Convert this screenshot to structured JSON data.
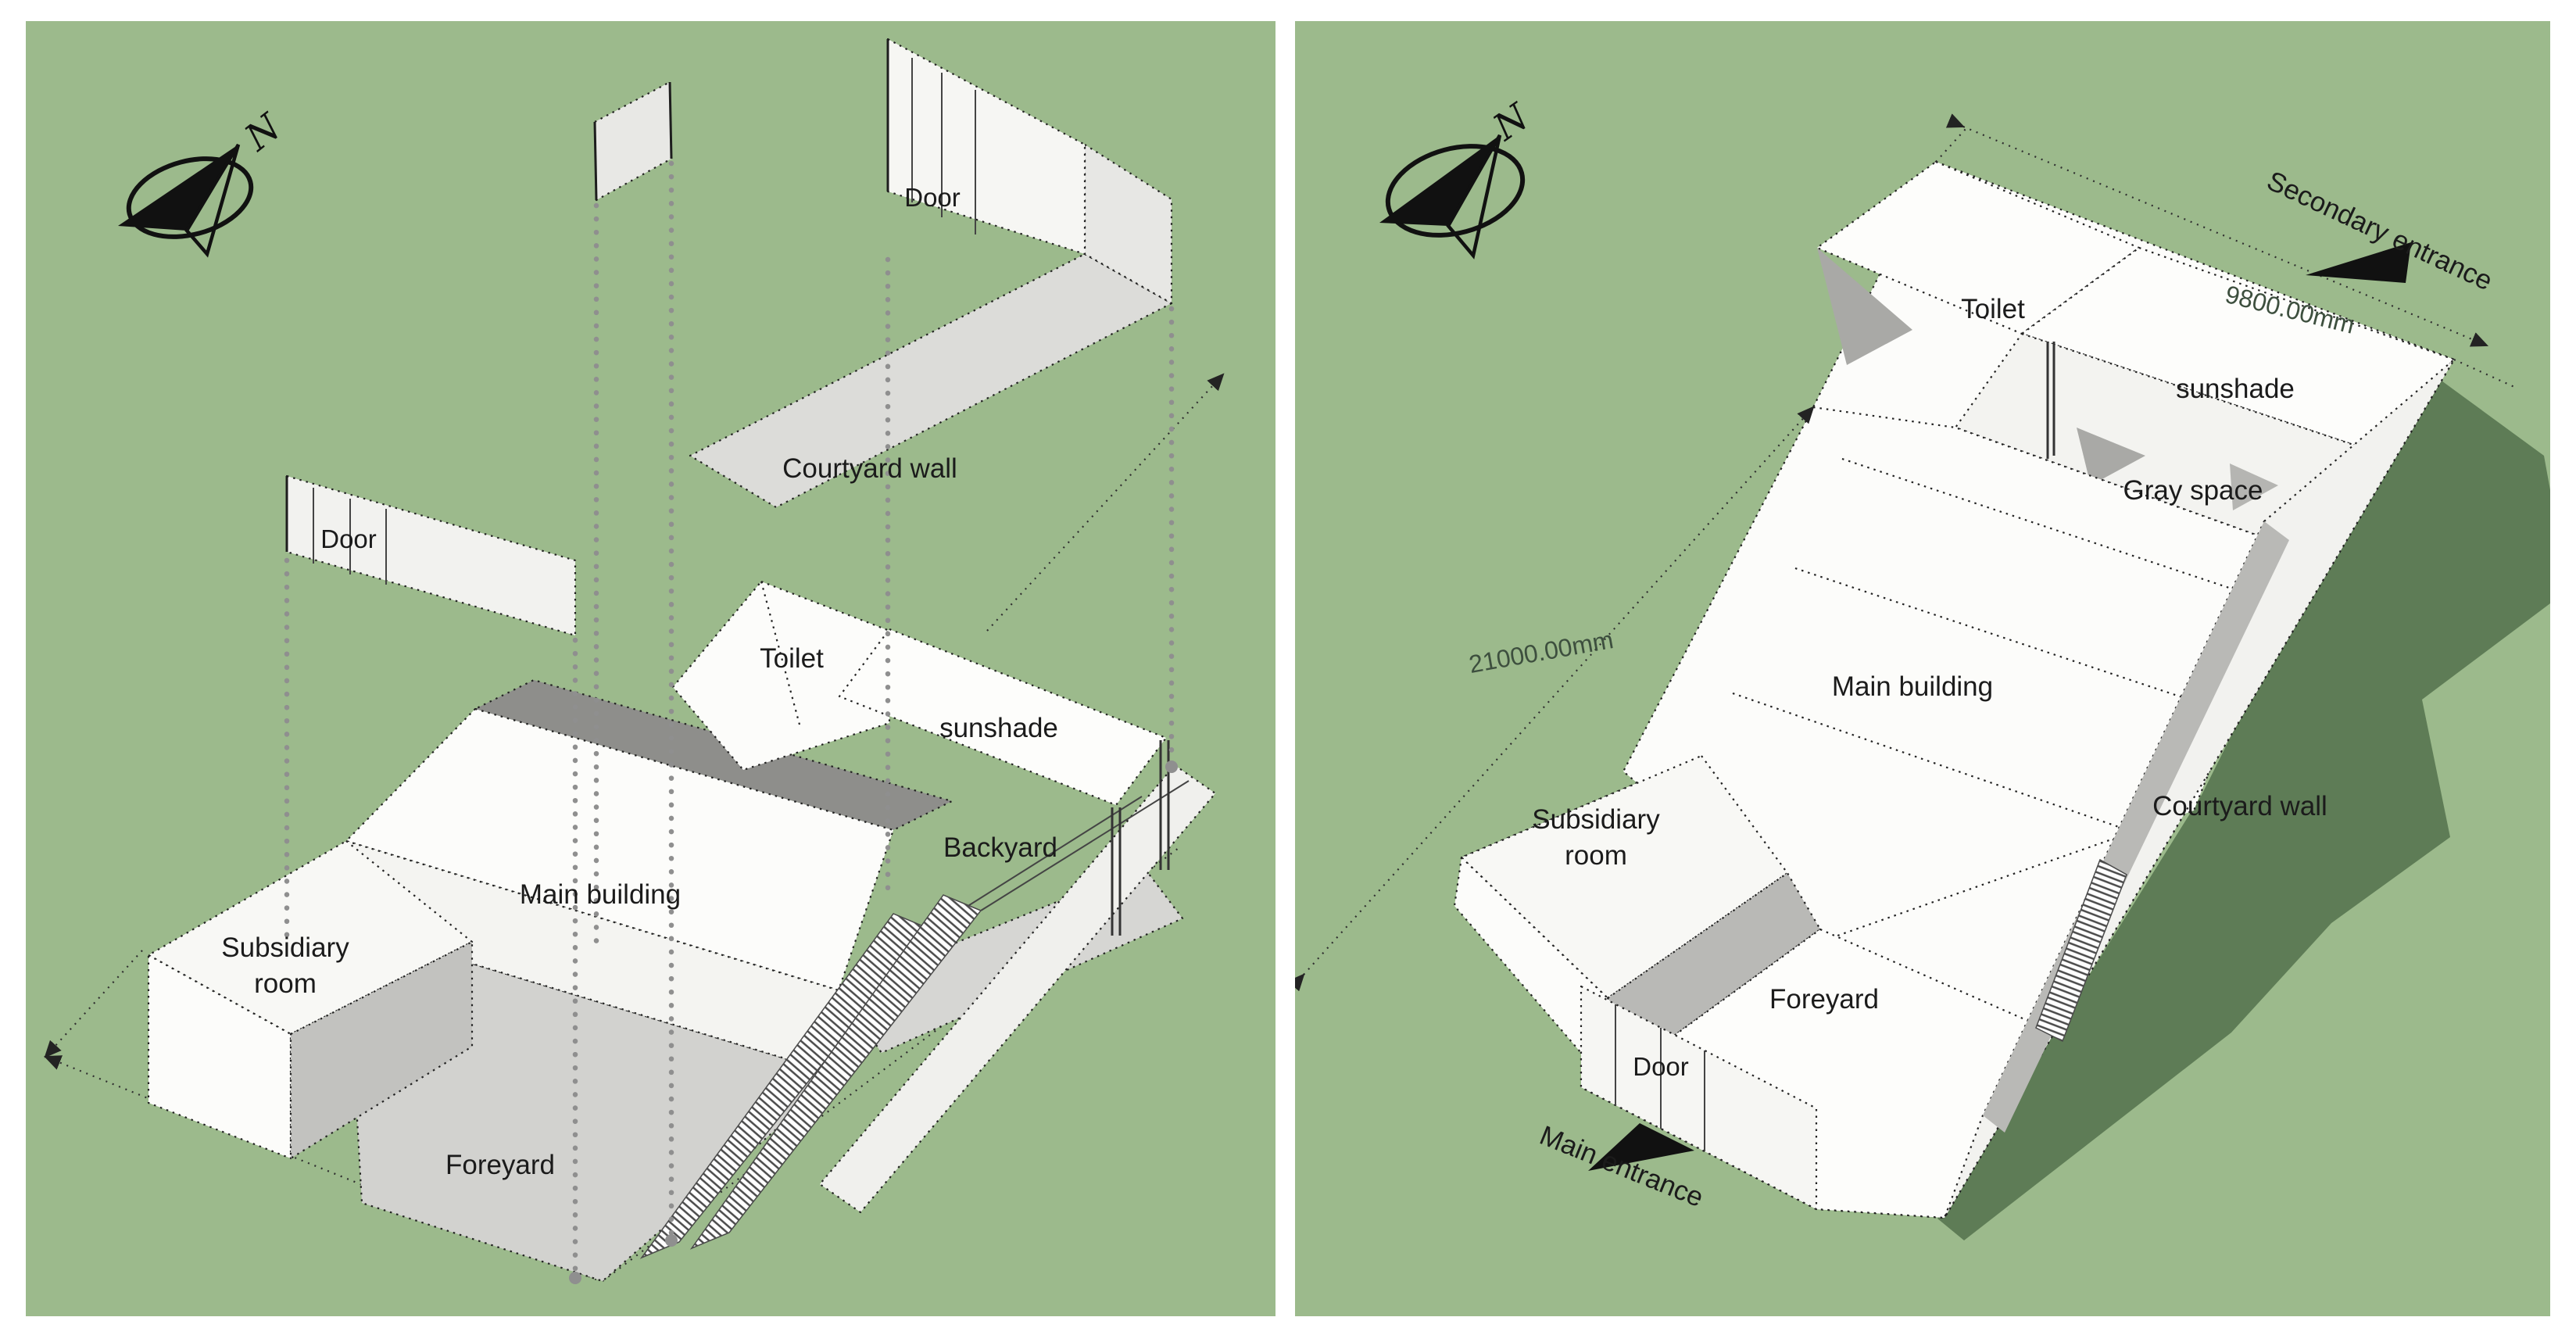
{
  "colors": {
    "ground_green": "#9cba8c",
    "shadow_green": "#5e7c56",
    "face_white": "#fcfcfa",
    "face_light_gray": "#e8e8e5",
    "floor_gray": "#d2d2cf",
    "mid_gray": "#b9b9b6",
    "dark_gray_roof": "#8e8e8b",
    "edge_black": "#232323",
    "projection_gray": "#8f8f8f",
    "dim_text": "#3d4f3e",
    "label_text": "#1b1b1b"
  },
  "left": {
    "compass_label": "N",
    "labels": {
      "door_top": "Door",
      "courtyard_wall": "Courtyard wall",
      "door_left": "Door",
      "toilet": "Toilet",
      "sunshade": "sunshade",
      "backyard": "Backyard",
      "main_building": "Main building",
      "subsidiary_line1": "Subsidiary",
      "subsidiary_line2": "room",
      "foreyard": "Foreyard"
    }
  },
  "right": {
    "compass_label": "N",
    "labels": {
      "secondary_entrance": "Secondary entrance",
      "toilet": "Toilet",
      "sunshade": "sunshade",
      "gray_space": "Gray space",
      "main_building": "Main building",
      "subsidiary_line1": "Subsidiary",
      "subsidiary_line2": "room",
      "courtyard_wall": "Courtyard wall",
      "foreyard": "Foreyard",
      "door": "Door",
      "main_entrance": "Main entrance"
    },
    "dimensions": {
      "side_length": "21000.00mm",
      "top_width": "9800.00mm"
    }
  }
}
